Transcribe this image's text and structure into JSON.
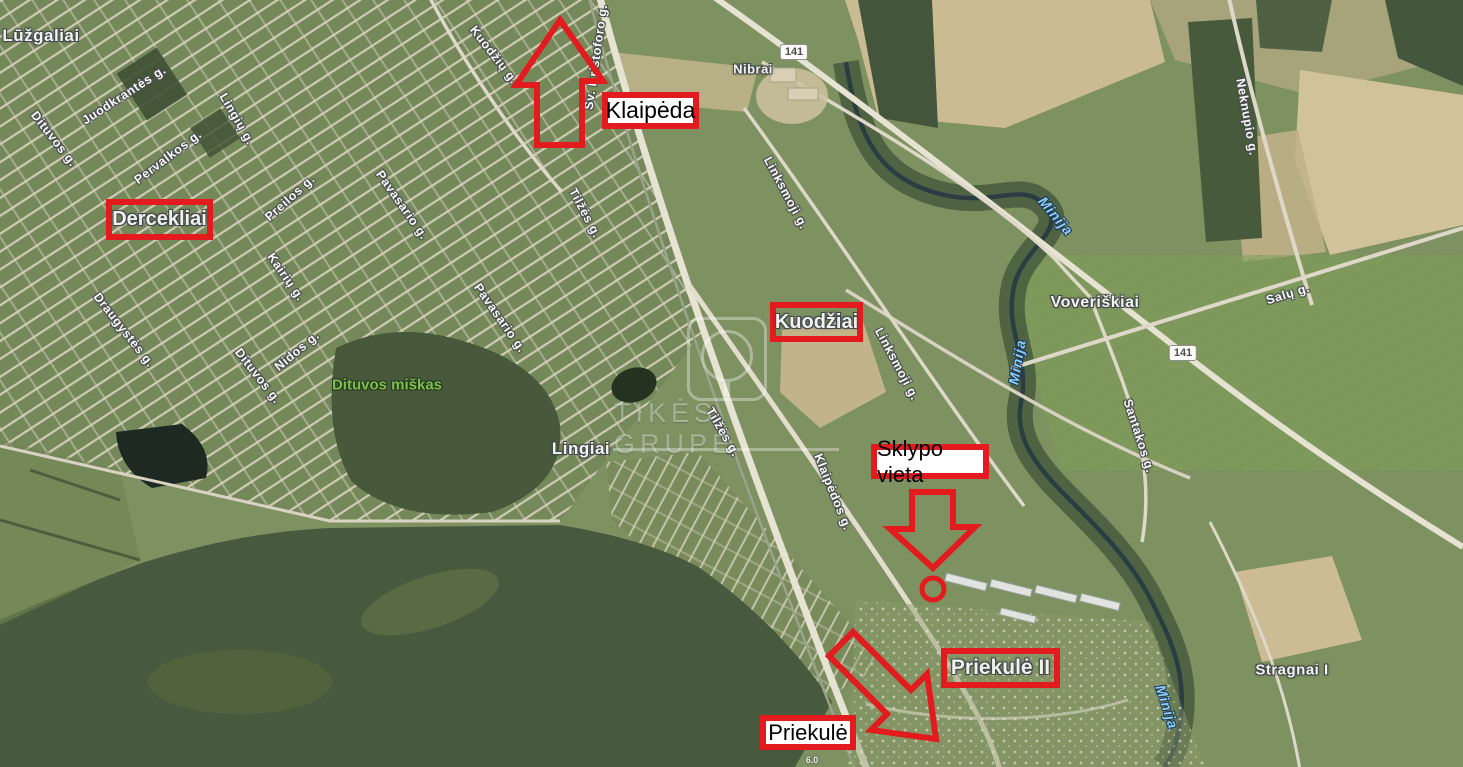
{
  "map_type": "satellite-map-with-plot-annotations",
  "colors": {
    "annotation_red": "#e31b1e",
    "filled_box_bg": "#ffffff",
    "water_label": "#8ecdf5",
    "forest_label": "#7cc04d",
    "map_label": "#f4f4f1"
  },
  "place_labels": [
    {
      "text": "Lūžgaliai"
    },
    {
      "text": "Nibrai"
    },
    {
      "text": "Voveriškiai"
    },
    {
      "text": "Lingiai"
    },
    {
      "text": "Stragnai I"
    }
  ],
  "street_labels": [
    {
      "text": "Juodkrantės g."
    },
    {
      "text": "Dituvos g."
    },
    {
      "text": "Lingių g."
    },
    {
      "text": "Pervalkos g."
    },
    {
      "text": "Preilos g."
    },
    {
      "text": "Pavasario g."
    },
    {
      "text": "Kairių g."
    },
    {
      "text": "Pavasario g."
    },
    {
      "text": "Nidos g."
    },
    {
      "text": "Dituvos g."
    },
    {
      "text": "Draugystės g."
    },
    {
      "text": "Tilžės g."
    },
    {
      "text": "Šv. Kristoforo g."
    },
    {
      "text": "Kuodžių g."
    },
    {
      "text": "Tilžės g."
    },
    {
      "text": "Klaipėdos g."
    },
    {
      "text": "Linksmoji g."
    },
    {
      "text": "Linksmoji g."
    },
    {
      "text": "Neknupio g."
    },
    {
      "text": "Salų g."
    },
    {
      "text": "Santakos g."
    }
  ],
  "water_labels": [
    {
      "text": "Minija"
    },
    {
      "text": "Minija"
    },
    {
      "text": "Minija"
    }
  ],
  "forest_label": {
    "text": "Dituvos miškas"
  },
  "road_badges": [
    {
      "text": "141"
    },
    {
      "text": "141"
    }
  ],
  "marker_label": {
    "text": "6.0"
  },
  "annotations": {
    "boxed_labels": [
      {
        "text": "Dercekliai",
        "style": "outline"
      },
      {
        "text": "Klaipėda",
        "style": "filled"
      },
      {
        "text": "Kuodžiai",
        "style": "outline"
      },
      {
        "text": "Sklypo vieta",
        "style": "filled"
      },
      {
        "text": "Priekulė II",
        "style": "outline"
      },
      {
        "text": "Priekulė",
        "style": "filled"
      }
    ],
    "arrows": [
      {
        "name": "arrow-up-to-klaipeda"
      },
      {
        "name": "arrow-down-to-plot"
      },
      {
        "name": "arrow-diagonal-to-priekule"
      }
    ],
    "marker_circle": {
      "name": "plot-location-circle"
    }
  },
  "watermark": {
    "text": "TIKĖS GRUPĖ"
  }
}
